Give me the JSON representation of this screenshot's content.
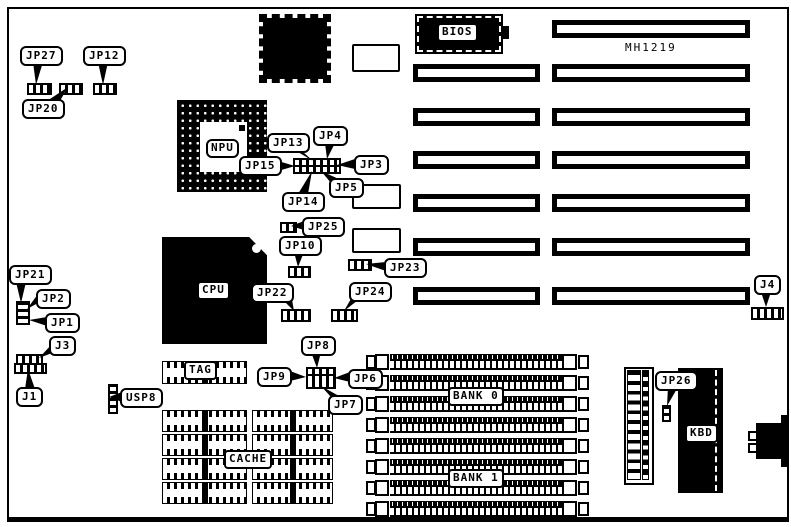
{
  "board": {
    "model": "MH1219"
  },
  "labels": {
    "jp1": "JP1",
    "jp2": "JP2",
    "jp3": "JP3",
    "jp4": "JP4",
    "jp5": "JP5",
    "jp6": "JP6",
    "jp7": "JP7",
    "jp8": "JP8",
    "jp9": "JP9",
    "jp10": "JP10",
    "jp12": "JP12",
    "jp13": "JP13",
    "jp14": "JP14",
    "jp15": "JP15",
    "jp20": "JP20",
    "jp21": "JP21",
    "jp22": "JP22",
    "jp23": "JP23",
    "jp24": "JP24",
    "jp25": "JP25",
    "jp26": "JP26",
    "jp27": "JP27",
    "j1": "J1",
    "j3": "J3",
    "j4": "J4",
    "usp8": "USP8"
  },
  "chips": {
    "npu": "NPU",
    "cpu": "CPU",
    "bios": "BIOS",
    "kbd": "KBD",
    "tag": "TAG",
    "cache": "CACHE",
    "bank0": "BANK 0",
    "bank1": "BANK 1"
  }
}
